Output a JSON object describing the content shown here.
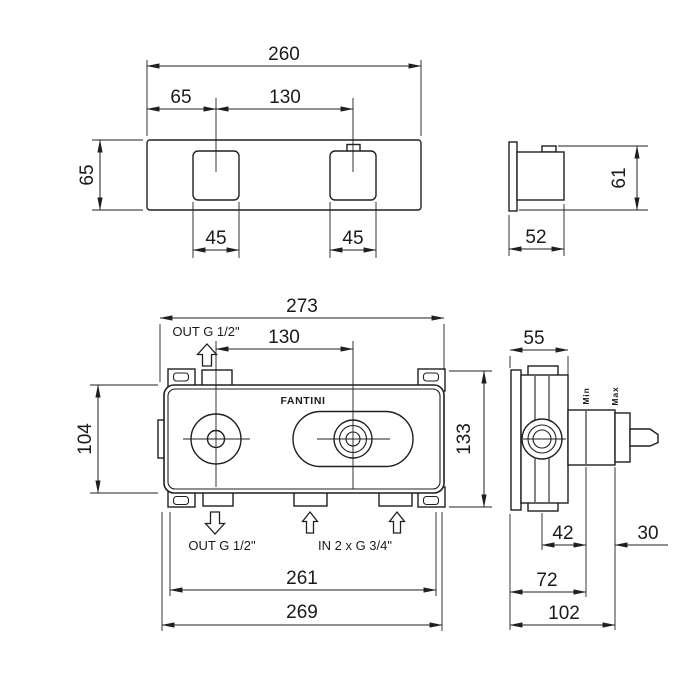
{
  "colors": {
    "line": "#1f1f1f",
    "background": "#ffffff"
  },
  "brand": "FANTINI",
  "front_view": {
    "overall_width": "260",
    "handle_offset": "65",
    "handle_spacing": "130",
    "plate_height": "65",
    "handle1_width": "45",
    "handle2_width": "45"
  },
  "handle_side_view": {
    "depth": "52",
    "height": "61"
  },
  "rough_in_view": {
    "overall_width": "273",
    "top_outlet_label": "OUT G 1/2\"",
    "port_spacing": "130",
    "body_height": "104",
    "frame_height": "133",
    "bottom_outlet_label": "OUT G 1/2\"",
    "inlet_label": "IN 2 x G 3/4\"",
    "body_width": "261",
    "frame_width": "269"
  },
  "rough_in_side_view": {
    "depth": "55",
    "min_label": "Min",
    "max_label": "Max",
    "wall_min_depth": "42",
    "adjustment_range": "30",
    "wall_mid_depth": "72",
    "wall_max_depth": "102"
  }
}
